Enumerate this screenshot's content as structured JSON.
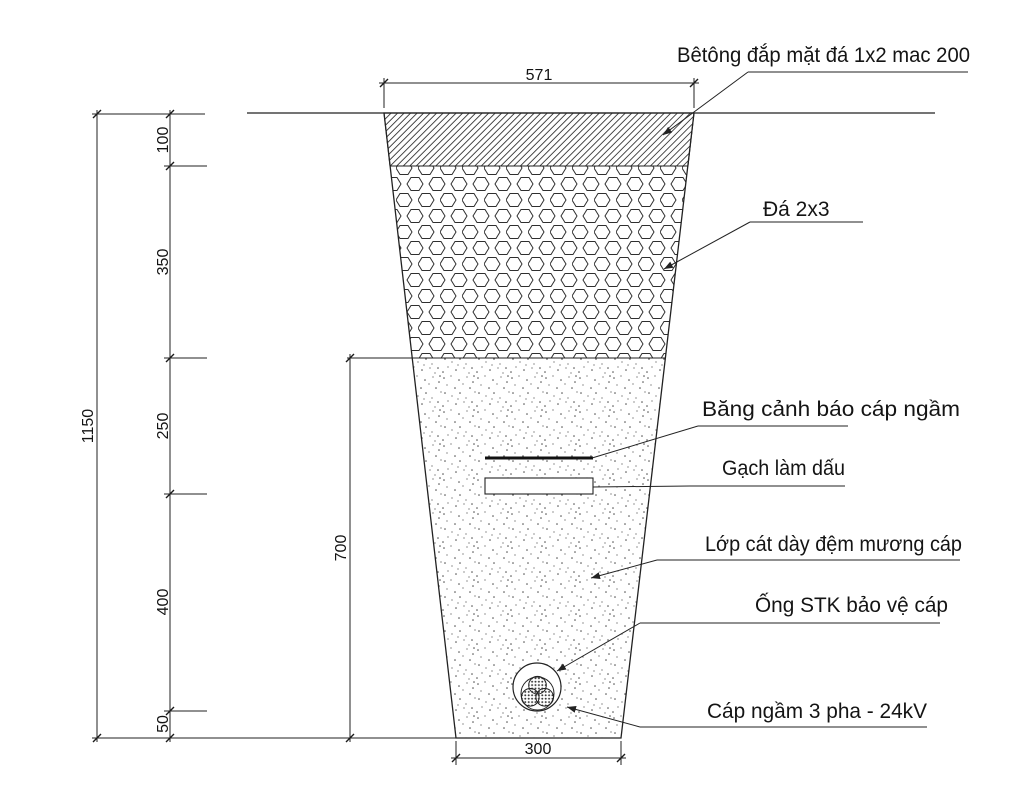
{
  "drawing_type": "cable-trench-cross-section",
  "labels": {
    "concrete": "Bêtông đắp mặt đá 1x2 mac 200",
    "stone": "Đá 2x3",
    "warning_tape": "Băng cảnh báo cáp ngầm",
    "marker_brick": "Gạch làm dấu",
    "sand": "Lớp cát dày đệm mương cáp",
    "pipe": "Ống STK bảo vệ cáp",
    "cable": "Cáp ngầm 3 pha - 24kV"
  },
  "dimensions": {
    "top_width": "571",
    "concrete_layer": "100",
    "stone_layer": "350",
    "tape_depth": "250",
    "cable_depth": "400",
    "bedding": "50",
    "total_depth": "1150",
    "trench_depth": "700",
    "bottom_width": "300"
  },
  "colors": {
    "line": "#222222",
    "background": "#ffffff"
  }
}
